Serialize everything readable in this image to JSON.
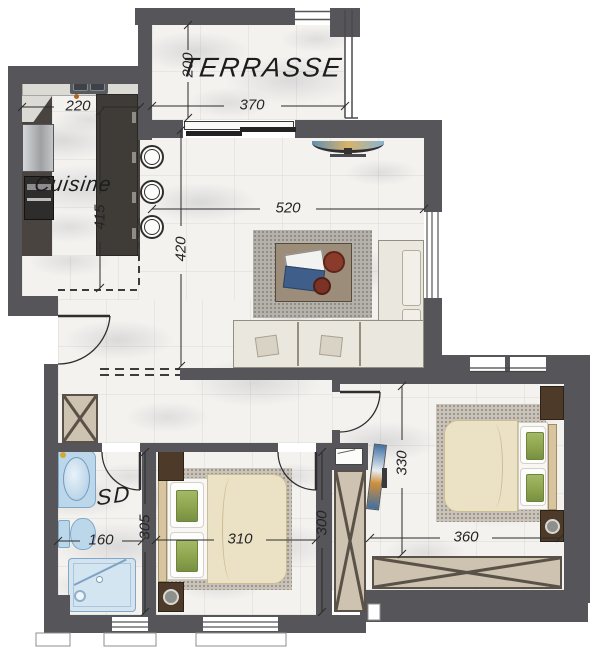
{
  "plan_title": "apartment-floor-plan",
  "rooms": {
    "terrace": {
      "label": "TERRASSE",
      "width": "370",
      "depth": "200"
    },
    "kitchen": {
      "label": "Cuisine",
      "width": "220",
      "length": "415"
    },
    "living": {
      "width": "520",
      "depth": "420"
    },
    "bathroom": {
      "label": "SD",
      "width": "160",
      "depth": "305"
    },
    "bedroom1": {
      "width": "310",
      "depth": "300"
    },
    "bedroom2": {
      "width": "360",
      "depth": "330"
    }
  },
  "colors": {
    "wall": "#56555a",
    "floor_base": "#f3f2ef",
    "kitchen_floor": "#49443f",
    "island": "#3f3b37",
    "counter": "#dcdad5",
    "wood_dark": "#4e3a28",
    "wardrobe": "#cec2b0",
    "wardrobe_line": "#5a5248",
    "rug": "#b5b1ab",
    "carpet": "#c8c2b9",
    "sofa": "#eae7df",
    "sofa_line": "#948f80",
    "duvet": "#ebe1c4",
    "duvet_line": "#cdbd95",
    "pillow_green": "#8ea44d",
    "bath_fixture": "#bdd7ea",
    "bath_stroke": "#7fa8c9",
    "shower": "#d3e5f1",
    "dim_line": "#2b2b2b",
    "tv_blue": "#5f8fb4",
    "tv_gold": "#d8b36a"
  }
}
